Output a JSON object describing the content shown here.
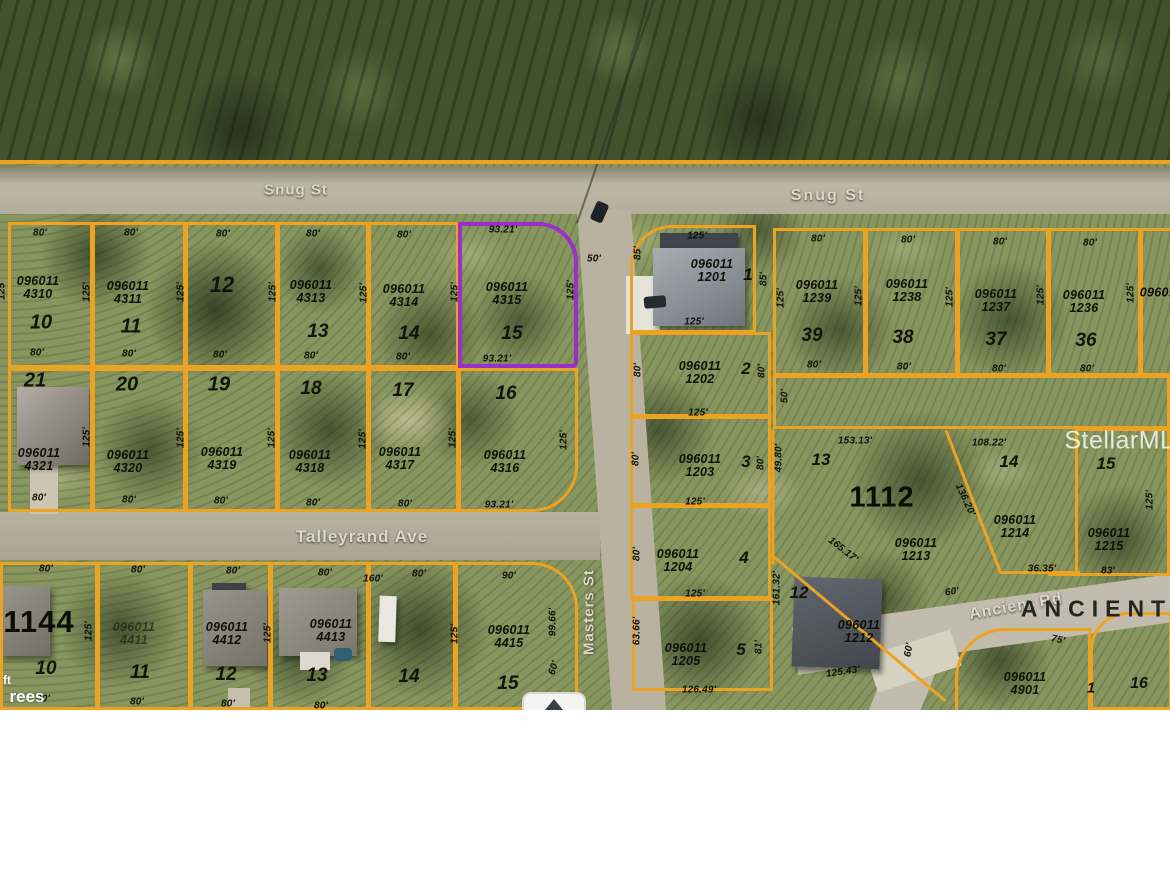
{
  "colors": {
    "boundary": "#eda322",
    "highlight": "#9c2fc9"
  },
  "watermarks": [
    {
      "t": "StellarMLS",
      "x": 1128,
      "y": 441,
      "s": 25
    }
  ],
  "partial_labels": [
    {
      "t": "ft",
      "x": 7,
      "y": 680,
      "s": 12
    },
    {
      "t": "rees",
      "x": 27,
      "y": 697,
      "s": 17
    }
  ],
  "street_labels": [
    {
      "t": "Snug St",
      "x": 296,
      "y": 190,
      "s": 15,
      "ls": 1,
      "r": 0
    },
    {
      "t": "Snug St",
      "x": 828,
      "y": 196,
      "s": 16,
      "ls": 2,
      "r": 0
    },
    {
      "t": "Talleyrand Ave",
      "x": 362,
      "y": 537,
      "s": 17,
      "ls": 1,
      "r": 0
    },
    {
      "t": "Masters St",
      "x": 589,
      "y": 612,
      "s": 15,
      "ls": 1,
      "r": -90
    },
    {
      "t": "Ancient Rd",
      "x": 1016,
      "y": 607,
      "s": 16,
      "ls": 1,
      "r": -10
    },
    {
      "t": "ANCIENT R",
      "x": 1115,
      "y": 609,
      "s": 23,
      "ls": 7,
      "r": 0,
      "v": "street-dark"
    }
  ],
  "block_labels": [
    {
      "t": "1144",
      "x": 39,
      "y": 622,
      "s": 31
    },
    {
      "t": "1112",
      "x": 882,
      "y": 498,
      "s": 29
    }
  ],
  "apns": [
    {
      "t": "096011 4310",
      "x": 38,
      "y": 288
    },
    {
      "t": "096011 4311",
      "x": 128,
      "y": 293
    },
    {
      "t": "096011 4313",
      "x": 311,
      "y": 292
    },
    {
      "t": "096011 4314",
      "x": 404,
      "y": 296
    },
    {
      "t": "096011 4315",
      "x": 507,
      "y": 294
    },
    {
      "t": "096011 4321",
      "x": 39,
      "y": 460
    },
    {
      "t": "096011 4320",
      "x": 128,
      "y": 462
    },
    {
      "t": "096011 4319",
      "x": 222,
      "y": 459
    },
    {
      "t": "096011 4318",
      "x": 310,
      "y": 462
    },
    {
      "t": "096011 4317",
      "x": 400,
      "y": 459
    },
    {
      "t": "096011 4316",
      "x": 505,
      "y": 462
    },
    {
      "t": "096011 4411",
      "x": 134,
      "y": 634,
      "o": 0.55
    },
    {
      "t": "096011 4412",
      "x": 227,
      "y": 634
    },
    {
      "t": "096011 4413",
      "x": 331,
      "y": 631
    },
    {
      "t": "096011 4415",
      "x": 509,
      "y": 637
    },
    {
      "t": "096011 1201",
      "x": 712,
      "y": 271
    },
    {
      "t": "096011 1202",
      "x": 700,
      "y": 373
    },
    {
      "t": "096011 1203",
      "x": 700,
      "y": 466
    },
    {
      "t": "096011 1204",
      "x": 678,
      "y": 561
    },
    {
      "t": "096011 1205",
      "x": 686,
      "y": 655
    },
    {
      "t": "096011 1239",
      "x": 817,
      "y": 292
    },
    {
      "t": "096011 1238",
      "x": 907,
      "y": 291
    },
    {
      "t": "096011 1237",
      "x": 996,
      "y": 301
    },
    {
      "t": "096011 1236",
      "x": 1084,
      "y": 302
    },
    {
      "t": "096011",
      "x": 1161,
      "y": 293
    },
    {
      "t": "096011 1213",
      "x": 916,
      "y": 550
    },
    {
      "t": "096011 1214",
      "x": 1015,
      "y": 527
    },
    {
      "t": "096011 1215",
      "x": 1109,
      "y": 540
    },
    {
      "t": "096011 1212",
      "x": 859,
      "y": 632
    },
    {
      "t": "096011 4901",
      "x": 1025,
      "y": 684
    }
  ],
  "lots": [
    {
      "t": "10",
      "x": 41,
      "y": 323,
      "s": 20
    },
    {
      "t": "11",
      "x": 131,
      "y": 327,
      "s": 20
    },
    {
      "t": "12",
      "x": 222,
      "y": 285,
      "s": 22
    },
    {
      "t": "13",
      "x": 318,
      "y": 332,
      "s": 19
    },
    {
      "t": "14",
      "x": 409,
      "y": 334,
      "s": 19
    },
    {
      "t": "15",
      "x": 512,
      "y": 334,
      "s": 19
    },
    {
      "t": "21",
      "x": 35,
      "y": 381,
      "s": 20
    },
    {
      "t": "20",
      "x": 127,
      "y": 385,
      "s": 20
    },
    {
      "t": "19",
      "x": 219,
      "y": 385,
      "s": 20
    },
    {
      "t": "18",
      "x": 311,
      "y": 389,
      "s": 19
    },
    {
      "t": "17",
      "x": 403,
      "y": 391,
      "s": 19
    },
    {
      "t": "16",
      "x": 506,
      "y": 394,
      "s": 19
    },
    {
      "t": "10",
      "x": 46,
      "y": 669,
      "s": 19
    },
    {
      "t": "11",
      "x": 140,
      "y": 673,
      "s": 19
    },
    {
      "t": "12",
      "x": 226,
      "y": 675,
      "s": 19
    },
    {
      "t": "13",
      "x": 317,
      "y": 676,
      "s": 19
    },
    {
      "t": "14",
      "x": 409,
      "y": 677,
      "s": 19
    },
    {
      "t": "15",
      "x": 508,
      "y": 684,
      "s": 19
    },
    {
      "t": "1",
      "x": 748,
      "y": 275,
      "s": 17
    },
    {
      "t": "2",
      "x": 746,
      "y": 369,
      "s": 17
    },
    {
      "t": "3",
      "x": 746,
      "y": 462,
      "s": 17
    },
    {
      "t": "4",
      "x": 744,
      "y": 558,
      "s": 17
    },
    {
      "t": "5",
      "x": 741,
      "y": 650,
      "s": 17
    },
    {
      "t": "39",
      "x": 812,
      "y": 336,
      "s": 19
    },
    {
      "t": "38",
      "x": 903,
      "y": 338,
      "s": 19
    },
    {
      "t": "37",
      "x": 996,
      "y": 340,
      "s": 19
    },
    {
      "t": "36",
      "x": 1086,
      "y": 341,
      "s": 19
    },
    {
      "t": "13",
      "x": 821,
      "y": 460,
      "s": 17
    },
    {
      "t": "14",
      "x": 1009,
      "y": 462,
      "s": 17
    },
    {
      "t": "15",
      "x": 1106,
      "y": 464,
      "s": 17
    },
    {
      "t": "12",
      "x": 799,
      "y": 593,
      "s": 17
    },
    {
      "t": "1",
      "x": 1091,
      "y": 688,
      "s": 15
    },
    {
      "t": "16",
      "x": 1139,
      "y": 684,
      "s": 16
    }
  ],
  "dims": [
    {
      "t": "80'",
      "x": 40,
      "y": 233
    },
    {
      "t": "80'",
      "x": 131,
      "y": 233
    },
    {
      "t": "80'",
      "x": 223,
      "y": 234
    },
    {
      "t": "80'",
      "x": 313,
      "y": 234
    },
    {
      "t": "80'",
      "x": 404,
      "y": 235
    },
    {
      "t": "93.21'",
      "x": 503,
      "y": 230
    },
    {
      "t": "80'",
      "x": 37,
      "y": 353
    },
    {
      "t": "80'",
      "x": 129,
      "y": 354
    },
    {
      "t": "80'",
      "x": 220,
      "y": 355
    },
    {
      "t": "80'",
      "x": 311,
      "y": 356
    },
    {
      "t": "80'",
      "x": 403,
      "y": 357
    },
    {
      "t": "93.21'",
      "x": 497,
      "y": 359
    },
    {
      "t": "125'",
      "x": 2,
      "y": 290,
      "r": -90
    },
    {
      "t": "125'",
      "x": 87,
      "y": 292,
      "r": -90
    },
    {
      "t": "125'",
      "x": 181,
      "y": 292,
      "r": -90
    },
    {
      "t": "125'",
      "x": 273,
      "y": 292,
      "r": -90
    },
    {
      "t": "125'",
      "x": 364,
      "y": 293,
      "r": -90
    },
    {
      "t": "125'",
      "x": 455,
      "y": 292,
      "r": -90
    },
    {
      "t": "125'",
      "x": 571,
      "y": 290,
      "r": -90
    },
    {
      "t": "125'",
      "x": 87,
      "y": 437,
      "r": -90
    },
    {
      "t": "125'",
      "x": 181,
      "y": 438,
      "r": -90
    },
    {
      "t": "125'",
      "x": 272,
      "y": 438,
      "r": -90
    },
    {
      "t": "125'",
      "x": 363,
      "y": 439,
      "r": -90
    },
    {
      "t": "125'",
      "x": 453,
      "y": 438,
      "r": -90
    },
    {
      "t": "125'",
      "x": 564,
      "y": 440,
      "r": -90
    },
    {
      "t": "80'",
      "x": 39,
      "y": 498
    },
    {
      "t": "80'",
      "x": 129,
      "y": 500
    },
    {
      "t": "80'",
      "x": 221,
      "y": 501
    },
    {
      "t": "80'",
      "x": 313,
      "y": 503
    },
    {
      "t": "80'",
      "x": 405,
      "y": 504
    },
    {
      "t": "93.21'",
      "x": 499,
      "y": 505
    },
    {
      "t": "80'",
      "x": 46,
      "y": 569
    },
    {
      "t": "80'",
      "x": 138,
      "y": 570
    },
    {
      "t": "80'",
      "x": 233,
      "y": 571
    },
    {
      "t": "80'",
      "x": 325,
      "y": 573
    },
    {
      "t": "160'",
      "x": 373,
      "y": 579
    },
    {
      "t": "80'",
      "x": 419,
      "y": 574
    },
    {
      "t": "90'",
      "x": 509,
      "y": 576
    },
    {
      "t": "125'",
      "x": 89,
      "y": 631,
      "r": -90
    },
    {
      "t": "125'",
      "x": 268,
      "y": 633,
      "r": -90
    },
    {
      "t": "125'",
      "x": 455,
      "y": 634,
      "r": -90
    },
    {
      "t": "99.66'",
      "x": 553,
      "y": 622,
      "r": -90
    },
    {
      "t": "80'",
      "x": 43,
      "y": 699
    },
    {
      "t": "80'",
      "x": 137,
      "y": 702
    },
    {
      "t": "80'",
      "x": 228,
      "y": 704
    },
    {
      "t": "80'",
      "x": 321,
      "y": 706
    },
    {
      "t": "50'",
      "x": 594,
      "y": 259
    },
    {
      "t": "60'",
      "x": 554,
      "y": 668,
      "r": -72
    },
    {
      "t": "125'",
      "x": 697,
      "y": 236
    },
    {
      "t": "85'",
      "x": 638,
      "y": 253,
      "r": -90
    },
    {
      "t": "85'",
      "x": 764,
      "y": 279,
      "r": -90
    },
    {
      "t": "125'",
      "x": 694,
      "y": 322
    },
    {
      "t": "80'",
      "x": 638,
      "y": 370,
      "r": -90
    },
    {
      "t": "80'",
      "x": 762,
      "y": 371,
      "r": -90
    },
    {
      "t": "125'",
      "x": 698,
      "y": 413
    },
    {
      "t": "80'",
      "x": 636,
      "y": 459,
      "r": -90
    },
    {
      "t": "80'",
      "x": 761,
      "y": 463,
      "r": -90
    },
    {
      "t": "125'",
      "x": 695,
      "y": 502
    },
    {
      "t": "80'",
      "x": 637,
      "y": 554,
      "r": -90
    },
    {
      "t": "125'",
      "x": 695,
      "y": 594
    },
    {
      "t": "63.66'",
      "x": 637,
      "y": 631,
      "r": -90
    },
    {
      "t": "81'",
      "x": 759,
      "y": 647,
      "r": -90
    },
    {
      "t": "126.49'",
      "x": 699,
      "y": 690
    },
    {
      "t": "80'",
      "x": 818,
      "y": 239
    },
    {
      "t": "80'",
      "x": 908,
      "y": 240
    },
    {
      "t": "80'",
      "x": 1000,
      "y": 242
    },
    {
      "t": "80'",
      "x": 1090,
      "y": 243
    },
    {
      "t": "125'",
      "x": 781,
      "y": 298,
      "r": -90
    },
    {
      "t": "125'",
      "x": 859,
      "y": 296,
      "r": -90
    },
    {
      "t": "125'",
      "x": 950,
      "y": 297,
      "r": -90
    },
    {
      "t": "125'",
      "x": 1041,
      "y": 295,
      "r": -90
    },
    {
      "t": "125'",
      "x": 1131,
      "y": 293,
      "r": -90
    },
    {
      "t": "80'",
      "x": 814,
      "y": 365
    },
    {
      "t": "80'",
      "x": 904,
      "y": 367
    },
    {
      "t": "80'",
      "x": 999,
      "y": 369
    },
    {
      "t": "80'",
      "x": 1087,
      "y": 369
    },
    {
      "t": "50'",
      "x": 785,
      "y": 396,
      "r": -90
    },
    {
      "t": "153.13'",
      "x": 855,
      "y": 441
    },
    {
      "t": "49.80'",
      "x": 779,
      "y": 458,
      "r": -90
    },
    {
      "t": "161.32'",
      "x": 777,
      "y": 588,
      "r": -90
    },
    {
      "t": "108.22'",
      "x": 989,
      "y": 443
    },
    {
      "t": "136.20'",
      "x": 965,
      "y": 500,
      "r": 65
    },
    {
      "t": "165.17'",
      "x": 843,
      "y": 550,
      "r": 38
    },
    {
      "t": "36.35'",
      "x": 1042,
      "y": 569
    },
    {
      "t": "83'",
      "x": 1108,
      "y": 571
    },
    {
      "t": "125'",
      "x": 1150,
      "y": 500,
      "r": -90
    },
    {
      "t": "125.43'",
      "x": 843,
      "y": 672,
      "r": -8
    },
    {
      "t": "75'",
      "x": 1058,
      "y": 640,
      "r": 12
    },
    {
      "t": "60'",
      "x": 952,
      "y": 592,
      "r": -8
    },
    {
      "t": "60'",
      "x": 909,
      "y": 650,
      "r": -80
    }
  ],
  "boundaries": [
    {
      "x": 8,
      "y": 222,
      "w": 85,
      "h": 146
    },
    {
      "x": 92,
      "y": 222,
      "w": 94,
      "h": 146
    },
    {
      "x": 185,
      "y": 222,
      "w": 93,
      "h": 146
    },
    {
      "x": 277,
      "y": 222,
      "w": 92,
      "h": 146
    },
    {
      "x": 368,
      "y": 222,
      "w": 91,
      "h": 146
    },
    {
      "x": 458,
      "y": 222,
      "w": 120,
      "h": 146,
      "rad": "0 40px 6px 0",
      "c": "p"
    },
    {
      "x": 8,
      "y": 368,
      "w": 85,
      "h": 144
    },
    {
      "x": 92,
      "y": 368,
      "w": 94,
      "h": 144
    },
    {
      "x": 185,
      "y": 368,
      "w": 93,
      "h": 144
    },
    {
      "x": 277,
      "y": 368,
      "w": 92,
      "h": 144
    },
    {
      "x": 368,
      "y": 368,
      "w": 91,
      "h": 144
    },
    {
      "x": 458,
      "y": 368,
      "w": 120,
      "h": 144,
      "rad": "0 0 46px 0"
    },
    {
      "x": 0,
      "y": 562,
      "w": 98,
      "h": 148
    },
    {
      "x": 97,
      "y": 562,
      "w": 94,
      "h": 148
    },
    {
      "x": 190,
      "y": 562,
      "w": 81,
      "h": 148
    },
    {
      "x": 270,
      "y": 562,
      "w": 99,
      "h": 148
    },
    {
      "x": 368,
      "y": 562,
      "w": 88,
      "h": 148
    },
    {
      "x": 455,
      "y": 562,
      "w": 123,
      "h": 148,
      "rad": "0 46px 0 0"
    },
    {
      "x": 630,
      "y": 225,
      "w": 126,
      "h": 108,
      "rad": "42px 0 0 0"
    },
    {
      "x": 630,
      "y": 332,
      "w": 141,
      "h": 85
    },
    {
      "x": 630,
      "y": 416,
      "w": 141,
      "h": 90
    },
    {
      "x": 630,
      "y": 505,
      "w": 141,
      "h": 94
    },
    {
      "x": 632,
      "y": 598,
      "w": 141,
      "h": 93
    },
    {
      "x": 773,
      "y": 228,
      "w": 93,
      "h": 148
    },
    {
      "x": 865,
      "y": 228,
      "w": 93,
      "h": 148
    },
    {
      "x": 957,
      "y": 228,
      "w": 92,
      "h": 148
    },
    {
      "x": 1048,
      "y": 228,
      "w": 93,
      "h": 148
    },
    {
      "x": 1140,
      "y": 228,
      "w": 40,
      "h": 148
    },
    {
      "x": 773,
      "y": 375,
      "w": 397,
      "h": 54
    },
    {
      "x": 1075,
      "y": 428,
      "w": 95,
      "h": 148
    },
    {
      "x": 955,
      "y": 628,
      "w": 136,
      "h": 85,
      "rad": "50px 0 0 0"
    },
    {
      "x": 1090,
      "y": 612,
      "w": 82,
      "h": 98,
      "rad": "38px 0 0 0"
    }
  ],
  "lines": [
    {
      "x": 0,
      "y": 160,
      "len": 1170,
      "rot": 0,
      "w": 4
    },
    {
      "x": 946,
      "y": 429,
      "len": 153,
      "rot": 69
    },
    {
      "x": 1000,
      "y": 571,
      "len": 80,
      "rot": 0
    },
    {
      "x": 1048,
      "y": 573,
      "len": 122,
      "rot": 0
    },
    {
      "x": 771,
      "y": 553,
      "len": 228,
      "rot": 40
    },
    {
      "x": 773,
      "y": 428,
      "len": 135,
      "rot": 90
    },
    {
      "x": 577,
      "y": 222,
      "len": 242,
      "rot": -71,
      "c": "d",
      "w": 2
    }
  ]
}
